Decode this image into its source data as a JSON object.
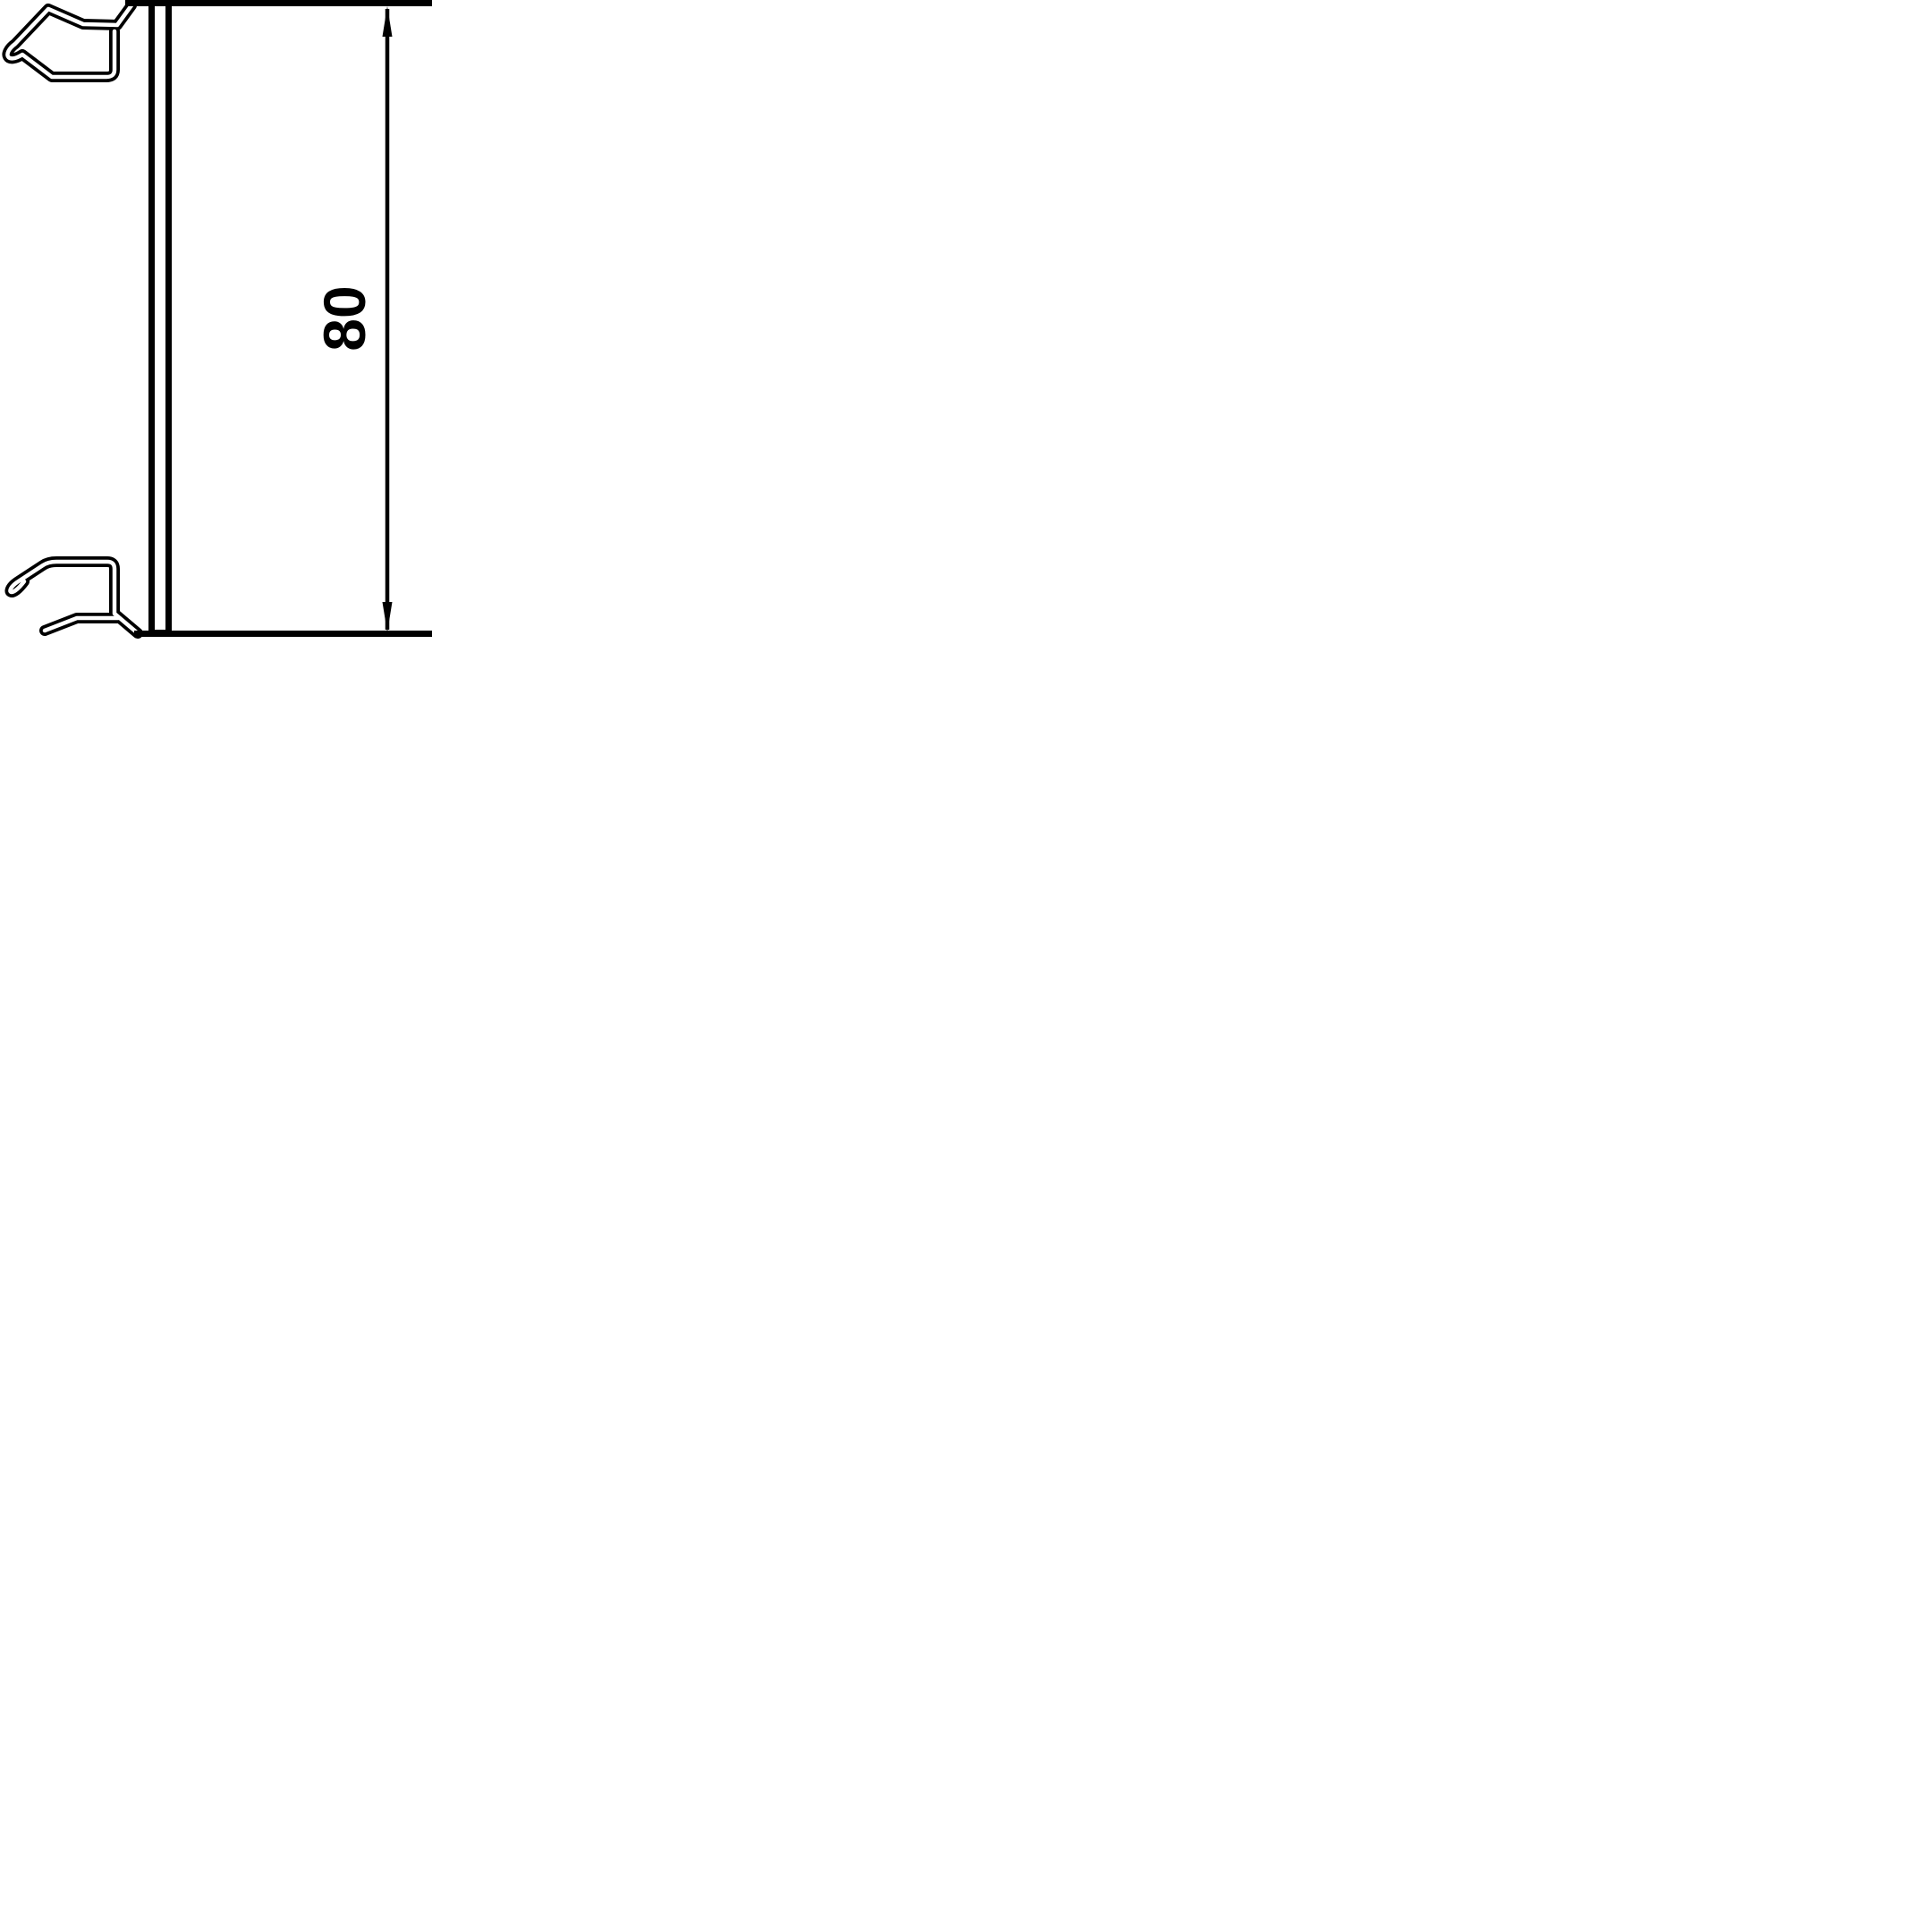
{
  "drawing": {
    "type": "technical-cross-section-profile",
    "background_color": "#ffffff",
    "line_color": "#000000",
    "dimension": {
      "label": "80",
      "orientation": "vertical",
      "arrows": [
        "up",
        "down"
      ]
    },
    "parts": {
      "panel": "lid-face-double-line",
      "top_clip": "spring-hook-upper",
      "bottom_clip": "spring-hook-lower"
    }
  }
}
